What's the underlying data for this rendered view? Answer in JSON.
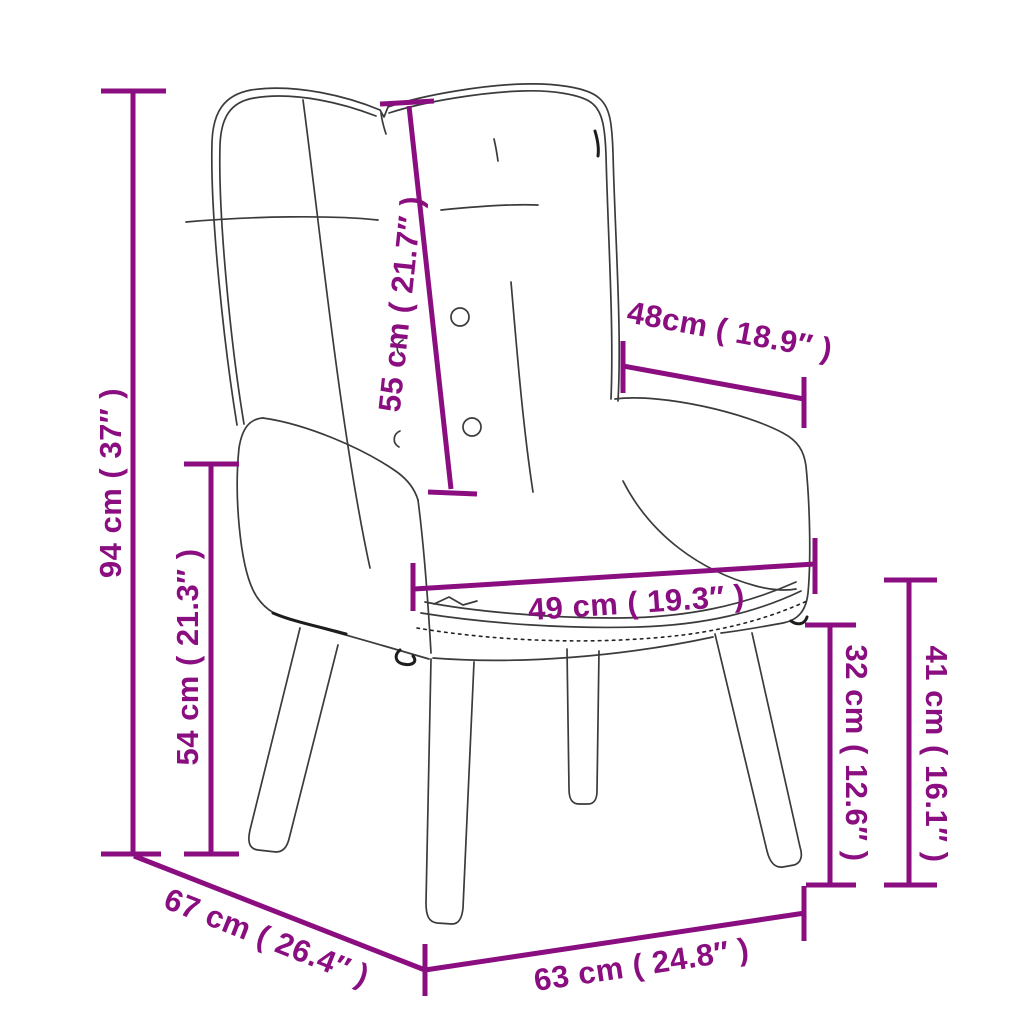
{
  "diagram": {
    "kind": "product-dimension-diagram",
    "subject": "wingback armchair line drawing",
    "accent_color": "#8A0E80",
    "line_color": "#3B3B3B",
    "background_color": "#FFFFFF",
    "dimensions": [
      {
        "name": "overall-height",
        "label": "94 cm ( 37″ )",
        "cm": 94,
        "inches": 37
      },
      {
        "name": "armrest-height",
        "label": "54 cm ( 21.3″ )",
        "cm": 54,
        "inches": 21.3
      },
      {
        "name": "backrest-length",
        "label": "55 cm ( 21.7″ )",
        "cm": 55,
        "inches": 21.7
      },
      {
        "name": "armrest-depth",
        "label": "48cm ( 18.9″ )",
        "cm": 48,
        "inches": 18.9
      },
      {
        "name": "seat-width",
        "label": "49 cm ( 19.3″ )",
        "cm": 49,
        "inches": 19.3
      },
      {
        "name": "under-seat-height",
        "label": "32 cm ( 12.6″ )",
        "cm": 32,
        "inches": 12.6
      },
      {
        "name": "seat-height",
        "label": "41 cm ( 16.1″ )",
        "cm": 41,
        "inches": 16.1
      },
      {
        "name": "overall-depth",
        "label": "67 cm ( 26.4″ )",
        "cm": 67,
        "inches": 26.4
      },
      {
        "name": "overall-width",
        "label": "63 cm ( 24.8″ )",
        "cm": 63,
        "inches": 24.8
      }
    ]
  }
}
